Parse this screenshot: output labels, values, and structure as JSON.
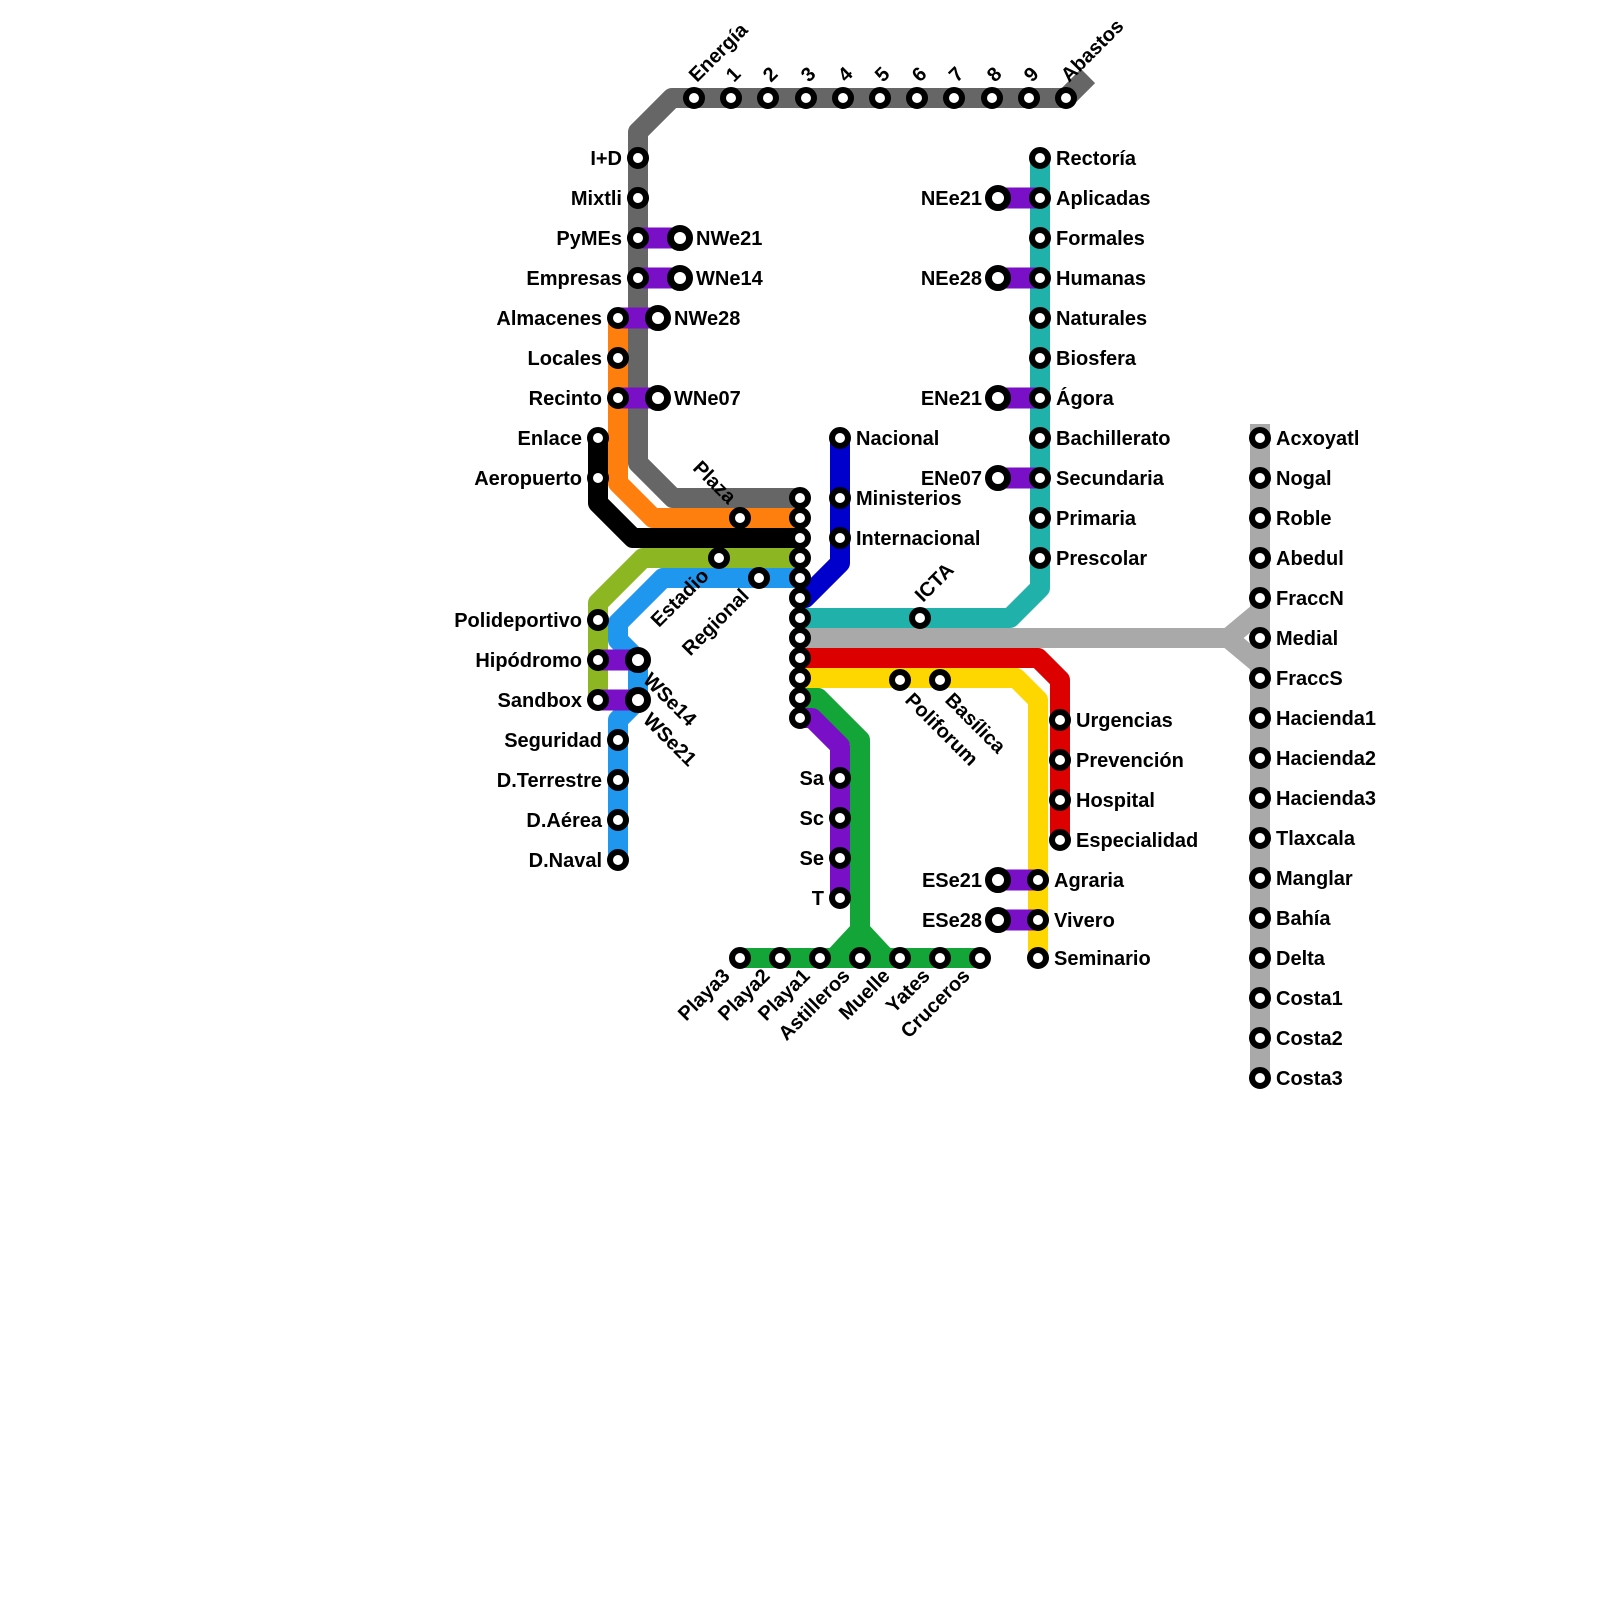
{
  "canvas": {
    "width": 1600,
    "height": 1600,
    "background": "#ffffff"
  },
  "style": {
    "line_width": 20,
    "connector_color": "#7a0fc8",
    "connector_width": 21,
    "station_fill": "#ffffff",
    "station_ring": "#000000",
    "station_r": 8,
    "station_stroke": 6,
    "transfer_r": 9.5,
    "transfer_stroke": 7,
    "label_size": 20
  },
  "interchange": {
    "x": 800,
    "ys": [
      498,
      518,
      538,
      558,
      578,
      598,
      618,
      638,
      658,
      678,
      698,
      718
    ]
  },
  "lines": [
    {
      "id": "gray",
      "color": "#666666",
      "paths": [
        [
          [
            1088,
            76
          ],
          [
            1066,
            98
          ],
          [
            672,
            98
          ],
          [
            638,
            132
          ],
          [
            638,
            463
          ],
          [
            673,
            498
          ],
          [
            800,
            498
          ]
        ]
      ]
    },
    {
      "id": "orange",
      "color": "#ff7f0e",
      "paths": [
        [
          [
            618,
            318
          ],
          [
            618,
            483
          ],
          [
            653,
            518
          ],
          [
            800,
            518
          ]
        ]
      ]
    },
    {
      "id": "black",
      "color": "#000000",
      "paths": [
        [
          [
            598,
            438
          ],
          [
            598,
            503
          ],
          [
            633,
            538
          ],
          [
            800,
            538
          ]
        ]
      ]
    },
    {
      "id": "olive",
      "color": "#8cb723",
      "paths": [
        [
          [
            800,
            558
          ],
          [
            643,
            558
          ],
          [
            598,
            603
          ],
          [
            598,
            700
          ]
        ]
      ]
    },
    {
      "id": "lightblue",
      "color": "#1f97ee",
      "paths": [
        [
          [
            800,
            578
          ],
          [
            663,
            578
          ],
          [
            618,
            623
          ],
          [
            618,
            640
          ],
          [
            638,
            660
          ],
          [
            638,
            700
          ],
          [
            618,
            720
          ],
          [
            618,
            860
          ]
        ]
      ]
    },
    {
      "id": "navy",
      "color": "#0000cd",
      "paths": [
        [
          [
            840,
            438
          ],
          [
            840,
            563
          ],
          [
            805,
            598
          ],
          [
            800,
            598
          ]
        ]
      ]
    },
    {
      "id": "teal",
      "color": "#20b2aa",
      "paths": [
        [
          [
            1040,
            158
          ],
          [
            1040,
            588
          ],
          [
            1010,
            618
          ],
          [
            800,
            618
          ]
        ]
      ]
    },
    {
      "id": "silver",
      "color": "#a9a9a9",
      "paths": [
        [
          [
            1260,
            424
          ],
          [
            1260,
            1078
          ]
        ],
        [
          [
            800,
            638
          ],
          [
            1228,
            638
          ]
        ],
        [
          [
            1228,
            638
          ],
          [
            1258,
            613
          ]
        ],
        [
          [
            1228,
            638
          ],
          [
            1258,
            663
          ]
        ]
      ]
    },
    {
      "id": "red",
      "color": "#dd0000",
      "paths": [
        [
          [
            800,
            658
          ],
          [
            1038,
            658
          ],
          [
            1060,
            680
          ],
          [
            1060,
            840
          ]
        ]
      ]
    },
    {
      "id": "yellow",
      "color": "#ffd700",
      "paths": [
        [
          [
            800,
            678
          ],
          [
            1016,
            678
          ],
          [
            1038,
            700
          ],
          [
            1038,
            958
          ]
        ]
      ]
    },
    {
      "id": "green",
      "color": "#13a538",
      "paths": [
        [
          [
            800,
            698
          ],
          [
            818,
            698
          ],
          [
            860,
            740
          ],
          [
            860,
            958
          ]
        ],
        [
          [
            740,
            958
          ],
          [
            980,
            958
          ]
        ],
        [
          [
            860,
            930
          ],
          [
            834,
            958
          ]
        ],
        [
          [
            860,
            930
          ],
          [
            886,
            958
          ]
        ]
      ]
    },
    {
      "id": "purple",
      "color": "#7a0fc8",
      "paths": [
        [
          [
            800,
            718
          ],
          [
            812,
            718
          ],
          [
            840,
            746
          ],
          [
            840,
            898
          ]
        ]
      ]
    }
  ],
  "connectors": [
    {
      "x1": 638,
      "y1": 238,
      "x2": 680,
      "y2": 238
    },
    {
      "x1": 638,
      "y1": 278,
      "x2": 680,
      "y2": 278
    },
    {
      "x1": 618,
      "y1": 318,
      "x2": 658,
      "y2": 318
    },
    {
      "x1": 618,
      "y1": 398,
      "x2": 658,
      "y2": 398
    },
    {
      "x1": 598,
      "y1": 660,
      "x2": 638,
      "y2": 660
    },
    {
      "x1": 598,
      "y1": 700,
      "x2": 638,
      "y2": 700
    },
    {
      "x1": 998,
      "y1": 198,
      "x2": 1040,
      "y2": 198
    },
    {
      "x1": 998,
      "y1": 278,
      "x2": 1040,
      "y2": 278
    },
    {
      "x1": 998,
      "y1": 398,
      "x2": 1040,
      "y2": 398
    },
    {
      "x1": 998,
      "y1": 478,
      "x2": 1040,
      "y2": 478
    },
    {
      "x1": 998,
      "y1": 880,
      "x2": 1038,
      "y2": 880
    },
    {
      "x1": 998,
      "y1": 920,
      "x2": 1038,
      "y2": 920
    }
  ],
  "stations": [
    {
      "label": "Energía",
      "x": 694,
      "y": 98,
      "line": "gray",
      "pl": "dus"
    },
    {
      "label": "1",
      "x": 731,
      "y": 98,
      "line": "gray",
      "pl": "dus"
    },
    {
      "label": "2",
      "x": 768,
      "y": 98,
      "line": "gray",
      "pl": "dus"
    },
    {
      "label": "3",
      "x": 806,
      "y": 98,
      "line": "gray",
      "pl": "dus"
    },
    {
      "label": "4",
      "x": 843,
      "y": 98,
      "line": "gray",
      "pl": "dus"
    },
    {
      "label": "5",
      "x": 880,
      "y": 98,
      "line": "gray",
      "pl": "dus"
    },
    {
      "label": "6",
      "x": 917,
      "y": 98,
      "line": "gray",
      "pl": "dus"
    },
    {
      "label": "7",
      "x": 954,
      "y": 98,
      "line": "gray",
      "pl": "dus"
    },
    {
      "label": "8",
      "x": 992,
      "y": 98,
      "line": "gray",
      "pl": "dus"
    },
    {
      "label": "9",
      "x": 1029,
      "y": 98,
      "line": "gray",
      "pl": "dus"
    },
    {
      "label": "Abastos",
      "x": 1066,
      "y": 98,
      "line": "gray",
      "pl": "dus"
    },
    {
      "label": "I+D",
      "x": 638,
      "y": 158,
      "line": "gray",
      "pl": "left"
    },
    {
      "label": "Mixtli",
      "x": 638,
      "y": 198,
      "line": "gray",
      "pl": "left"
    },
    {
      "label": "PyMEs",
      "x": 638,
      "y": 238,
      "line": "gray",
      "pl": "left"
    },
    {
      "label": "Empresas",
      "x": 638,
      "y": 278,
      "line": "gray",
      "pl": "left"
    },
    {
      "label": "NWe21",
      "x": 680,
      "y": 238,
      "line": "transfer",
      "pl": "right",
      "xf": true
    },
    {
      "label": "WNe14",
      "x": 680,
      "y": 278,
      "line": "transfer",
      "pl": "right",
      "xf": true
    },
    {
      "label": "NWe28",
      "x": 658,
      "y": 318,
      "line": "transfer",
      "pl": "right",
      "xf": true
    },
    {
      "label": "WNe07",
      "x": 658,
      "y": 398,
      "line": "transfer",
      "pl": "right",
      "xf": true
    },
    {
      "label": "Almacenes",
      "x": 618,
      "y": 318,
      "line": "orange",
      "pl": "left"
    },
    {
      "label": "Locales",
      "x": 618,
      "y": 358,
      "line": "orange",
      "pl": "left"
    },
    {
      "label": "Recinto",
      "x": 618,
      "y": 398,
      "line": "orange",
      "pl": "left"
    },
    {
      "label": "Plaza",
      "x": 740,
      "y": 518,
      "line": "orange",
      "pl": "dde"
    },
    {
      "label": "Enlace",
      "x": 598,
      "y": 438,
      "line": "black",
      "pl": "left"
    },
    {
      "label": "Aeropuerto",
      "x": 598,
      "y": 478,
      "line": "black",
      "pl": "left"
    },
    {
      "label": "Polideportivo",
      "x": 598,
      "y": 620,
      "line": "olive",
      "pl": "left"
    },
    {
      "label": "Hipódromo",
      "x": 598,
      "y": 660,
      "line": "olive",
      "pl": "left"
    },
    {
      "label": "Sandbox",
      "x": 598,
      "y": 700,
      "line": "olive",
      "pl": "left"
    },
    {
      "label": "Estadio",
      "x": 719,
      "y": 558,
      "line": "olive",
      "pl": "due"
    },
    {
      "label": "WSe14",
      "x": 638,
      "y": 660,
      "line": "lightblue",
      "pl": "dds",
      "xf": true
    },
    {
      "label": "WSe21",
      "x": 638,
      "y": 700,
      "line": "lightblue",
      "pl": "dds",
      "xf": true
    },
    {
      "label": "Seguridad",
      "x": 618,
      "y": 740,
      "line": "lightblue",
      "pl": "left"
    },
    {
      "label": "D.Terrestre",
      "x": 618,
      "y": 780,
      "line": "lightblue",
      "pl": "left"
    },
    {
      "label": "D.Aérea",
      "x": 618,
      "y": 820,
      "line": "lightblue",
      "pl": "left"
    },
    {
      "label": "D.Naval",
      "x": 618,
      "y": 860,
      "line": "lightblue",
      "pl": "left"
    },
    {
      "label": "Regional",
      "x": 759,
      "y": 578,
      "line": "lightblue",
      "pl": "due"
    },
    {
      "label": "Nacional",
      "x": 840,
      "y": 438,
      "line": "navy",
      "pl": "right"
    },
    {
      "label": "Ministerios",
      "x": 840,
      "y": 498,
      "line": "navy",
      "pl": "right"
    },
    {
      "label": "Internacional",
      "x": 840,
      "y": 538,
      "line": "navy",
      "pl": "right"
    },
    {
      "label": "Rectoría",
      "x": 1040,
      "y": 158,
      "line": "teal",
      "pl": "right"
    },
    {
      "label": "Aplicadas",
      "x": 1040,
      "y": 198,
      "line": "teal",
      "pl": "right"
    },
    {
      "label": "Formales",
      "x": 1040,
      "y": 238,
      "line": "teal",
      "pl": "right"
    },
    {
      "label": "Humanas",
      "x": 1040,
      "y": 278,
      "line": "teal",
      "pl": "right"
    },
    {
      "label": "Naturales",
      "x": 1040,
      "y": 318,
      "line": "teal",
      "pl": "right"
    },
    {
      "label": "Biosfera",
      "x": 1040,
      "y": 358,
      "line": "teal",
      "pl": "right"
    },
    {
      "label": "Ágora",
      "x": 1040,
      "y": 398,
      "line": "teal",
      "pl": "right"
    },
    {
      "label": "Bachillerato",
      "x": 1040,
      "y": 438,
      "line": "teal",
      "pl": "right"
    },
    {
      "label": "Secundaria",
      "x": 1040,
      "y": 478,
      "line": "teal",
      "pl": "right"
    },
    {
      "label": "Primaria",
      "x": 1040,
      "y": 518,
      "line": "teal",
      "pl": "right"
    },
    {
      "label": "Prescolar",
      "x": 1040,
      "y": 558,
      "line": "teal",
      "pl": "right"
    },
    {
      "label": "ICTA",
      "x": 920,
      "y": 618,
      "line": "teal",
      "pl": "dus"
    },
    {
      "label": "NEe21",
      "x": 998,
      "y": 198,
      "line": "transfer",
      "pl": "left",
      "xf": true
    },
    {
      "label": "NEe28",
      "x": 998,
      "y": 278,
      "line": "transfer",
      "pl": "left",
      "xf": true
    },
    {
      "label": "ENe21",
      "x": 998,
      "y": 398,
      "line": "transfer",
      "pl": "left",
      "xf": true
    },
    {
      "label": "ENe07",
      "x": 998,
      "y": 478,
      "line": "transfer",
      "pl": "left",
      "xf": true
    },
    {
      "label": "Acxoyatl",
      "x": 1260,
      "y": 438,
      "line": "silver",
      "pl": "right"
    },
    {
      "label": "Nogal",
      "x": 1260,
      "y": 478,
      "line": "silver",
      "pl": "right"
    },
    {
      "label": "Roble",
      "x": 1260,
      "y": 518,
      "line": "silver",
      "pl": "right"
    },
    {
      "label": "Abedul",
      "x": 1260,
      "y": 558,
      "line": "silver",
      "pl": "right"
    },
    {
      "label": "FraccN",
      "x": 1260,
      "y": 598,
      "line": "silver",
      "pl": "right"
    },
    {
      "label": "Medial",
      "x": 1260,
      "y": 638,
      "line": "silver",
      "pl": "right"
    },
    {
      "label": "FraccS",
      "x": 1260,
      "y": 678,
      "line": "silver",
      "pl": "right"
    },
    {
      "label": "Hacienda1",
      "x": 1260,
      "y": 718,
      "line": "silver",
      "pl": "right"
    },
    {
      "label": "Hacienda2",
      "x": 1260,
      "y": 758,
      "line": "silver",
      "pl": "right"
    },
    {
      "label": "Hacienda3",
      "x": 1260,
      "y": 798,
      "line": "silver",
      "pl": "right"
    },
    {
      "label": "Tlaxcala",
      "x": 1260,
      "y": 838,
      "line": "silver",
      "pl": "right"
    },
    {
      "label": "Manglar",
      "x": 1260,
      "y": 878,
      "line": "silver",
      "pl": "right"
    },
    {
      "label": "Bahía",
      "x": 1260,
      "y": 918,
      "line": "silver",
      "pl": "right"
    },
    {
      "label": "Delta",
      "x": 1260,
      "y": 958,
      "line": "silver",
      "pl": "right"
    },
    {
      "label": "Costa1",
      "x": 1260,
      "y": 998,
      "line": "silver",
      "pl": "right"
    },
    {
      "label": "Costa2",
      "x": 1260,
      "y": 1038,
      "line": "silver",
      "pl": "right"
    },
    {
      "label": "Costa3",
      "x": 1260,
      "y": 1078,
      "line": "silver",
      "pl": "right"
    },
    {
      "label": "Urgencias",
      "x": 1060,
      "y": 720,
      "line": "red",
      "pl": "right"
    },
    {
      "label": "Prevención",
      "x": 1060,
      "y": 760,
      "line": "red",
      "pl": "right"
    },
    {
      "label": "Hospital",
      "x": 1060,
      "y": 800,
      "line": "red",
      "pl": "right"
    },
    {
      "label": "Especialidad",
      "x": 1060,
      "y": 840,
      "line": "red",
      "pl": "right"
    },
    {
      "label": "Poliforum",
      "x": 900,
      "y": 680,
      "line": "yellow",
      "pl": "dds"
    },
    {
      "label": "Basílica",
      "x": 940,
      "y": 680,
      "line": "yellow",
      "pl": "dds"
    },
    {
      "label": "Agraria",
      "x": 1038,
      "y": 880,
      "line": "yellow",
      "pl": "right"
    },
    {
      "label": "Vivero",
      "x": 1038,
      "y": 920,
      "line": "yellow",
      "pl": "right"
    },
    {
      "label": "Seminario",
      "x": 1038,
      "y": 958,
      "line": "yellow",
      "pl": "right"
    },
    {
      "label": "ESe21",
      "x": 998,
      "y": 880,
      "line": "transfer",
      "pl": "left",
      "xf": true
    },
    {
      "label": "ESe28",
      "x": 998,
      "y": 920,
      "line": "transfer",
      "pl": "left",
      "xf": true
    },
    {
      "label": "Playa3",
      "x": 740,
      "y": 958,
      "line": "green",
      "pl": "due"
    },
    {
      "label": "Playa2",
      "x": 780,
      "y": 958,
      "line": "green",
      "pl": "due"
    },
    {
      "label": "Playa1",
      "x": 820,
      "y": 958,
      "line": "green",
      "pl": "due"
    },
    {
      "label": "Astilleros",
      "x": 860,
      "y": 958,
      "line": "green",
      "pl": "due"
    },
    {
      "label": "Muelle",
      "x": 900,
      "y": 958,
      "line": "green",
      "pl": "due"
    },
    {
      "label": "Yates",
      "x": 940,
      "y": 958,
      "line": "green",
      "pl": "due"
    },
    {
      "label": "Cruceros",
      "x": 980,
      "y": 958,
      "line": "green",
      "pl": "due"
    },
    {
      "label": "Sa",
      "x": 840,
      "y": 778,
      "line": "purple",
      "pl": "left"
    },
    {
      "label": "Sc",
      "x": 840,
      "y": 818,
      "line": "purple",
      "pl": "left"
    },
    {
      "label": "Se",
      "x": 840,
      "y": 858,
      "line": "purple",
      "pl": "left"
    },
    {
      "label": "T",
      "x": 840,
      "y": 898,
      "line": "purple",
      "pl": "left"
    }
  ]
}
